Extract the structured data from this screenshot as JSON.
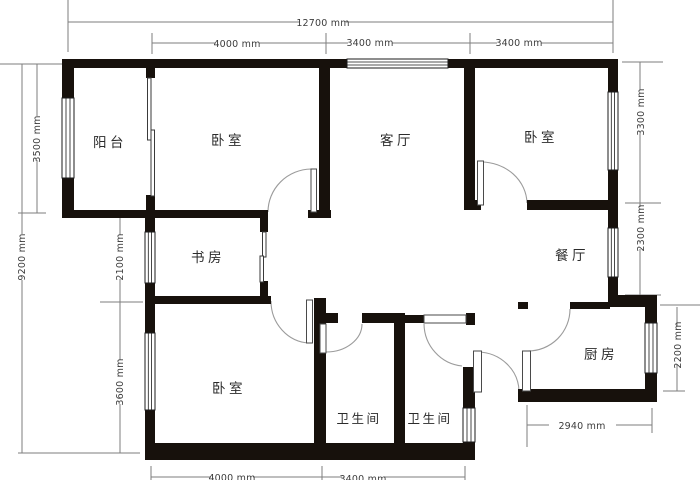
{
  "floorplan": {
    "title": "apartment-floor-plan",
    "rooms": {
      "balcony": {
        "name": "阳台"
      },
      "bedroom_nw": {
        "name": "卧室"
      },
      "living": {
        "name": "客厅"
      },
      "bedroom_ne": {
        "name": "卧室"
      },
      "study": {
        "name": "书房"
      },
      "dining": {
        "name": "餐厅"
      },
      "bedroom_sw": {
        "name": "卧室"
      },
      "bath_west": {
        "name": "卫生间"
      },
      "bath_east": {
        "name": "卫生间"
      },
      "kitchen": {
        "name": "厨房"
      }
    },
    "dimensions": {
      "top_total": "12700 mm",
      "top_a": "4000 mm",
      "top_b": "3400 mm",
      "top_c": "3400 mm",
      "left_total": "9200 mm",
      "left_a": "3500 mm",
      "left_b": "2100 mm",
      "left_c": "3600 mm",
      "right_a": "3300 mm",
      "right_b": "2300 mm",
      "right_c": "2200 mm",
      "bottom_a": "4000 mm",
      "bottom_b": "3400 mm",
      "bottom_kitchen": "2940 mm"
    },
    "colors": {
      "wall": "#17110c",
      "dimension_line": "#7e7e7e",
      "text": "#2b2b2b",
      "background": "#ffffff"
    }
  }
}
